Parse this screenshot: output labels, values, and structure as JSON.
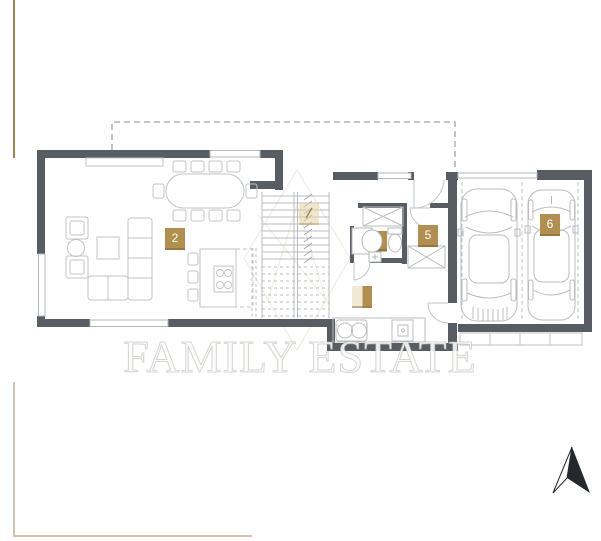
{
  "plan": {
    "watermark_text": "FAMILY ESTATE",
    "labels": {
      "living": "2",
      "storage": "5",
      "garage": "6",
      "stairs_faded": "",
      "hall_faded": ""
    },
    "icons": {
      "north_arrow": "north-arrow",
      "logo": "family-estate-diamond-logo"
    },
    "colors": {
      "wall": "#575d62",
      "furniture_line": "#c0c4c6",
      "dashed_line": "#9fa5a8",
      "label_gold": "#b28f4e",
      "label_gold_pale": "#eee4c9",
      "frame_gold": "#a5854a",
      "frame_pale": "#cdc4ab",
      "watermark": "#ffffff"
    }
  }
}
